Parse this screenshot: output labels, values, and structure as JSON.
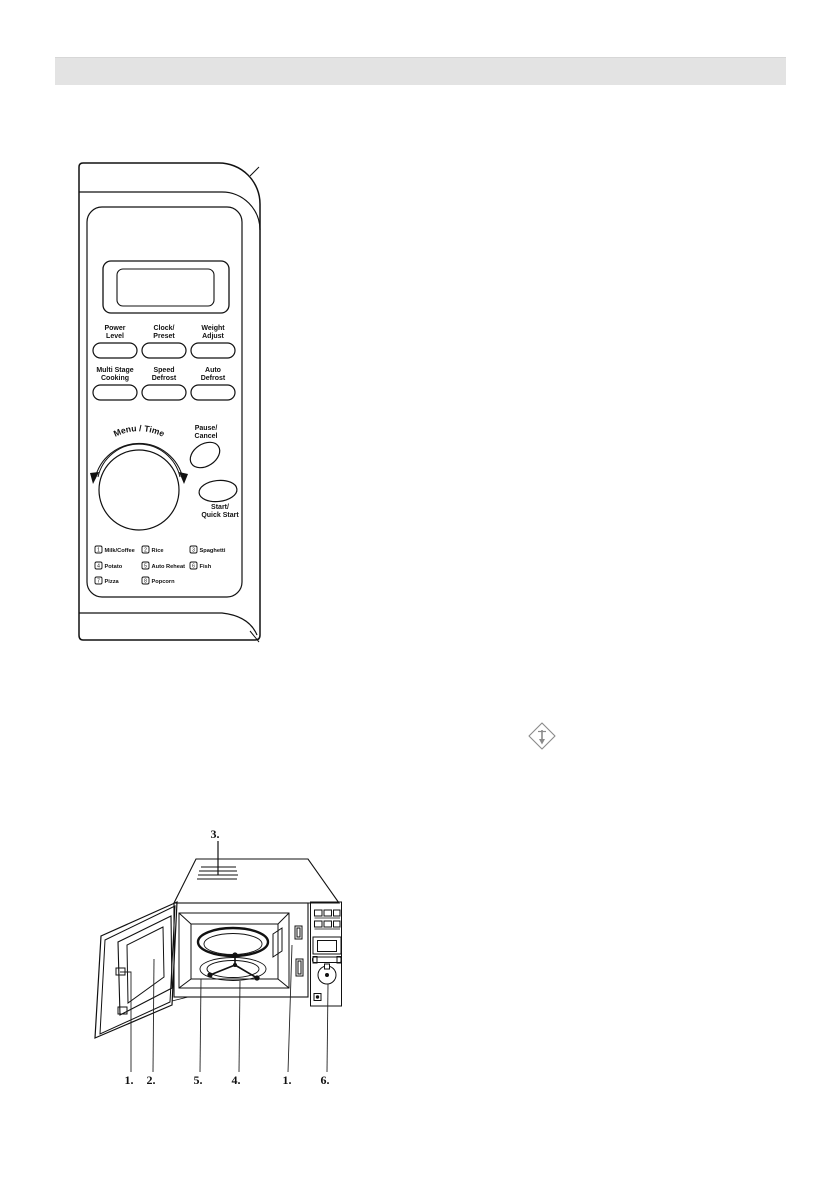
{
  "page": {
    "background_color": "#ffffff",
    "header_bar_color": "#e3e3e3",
    "line_color": "#111111",
    "diamond_icon_color": "#8a8a8a"
  },
  "icons": {
    "certification_mark": "diamond-certification-icon"
  },
  "control_panel": {
    "buttons": [
      {
        "line1": "Power",
        "line2": "Level"
      },
      {
        "line1": "Clock/",
        "line2": "Preset"
      },
      {
        "line1": "Weight",
        "line2": "Adjust"
      },
      {
        "line1": "Multi Stage",
        "line2": "Cooking"
      },
      {
        "line1": "Speed",
        "line2": "Defrost"
      },
      {
        "line1": "Auto",
        "line2": "Defrost"
      }
    ],
    "dial_label": "Menu / Time",
    "pause_button": {
      "line1": "Pause/",
      "line2": "Cancel"
    },
    "start_button": {
      "line1": "Start/",
      "line2": "Quick Start"
    },
    "presets": [
      {
        "num": "1",
        "label": "Milk/Coffee"
      },
      {
        "num": "2",
        "label": "Rice"
      },
      {
        "num": "3",
        "label": "Spaghetti"
      },
      {
        "num": "4",
        "label": "Potato"
      },
      {
        "num": "5",
        "label": "Auto Reheat"
      },
      {
        "num": "6",
        "label": "Fish"
      },
      {
        "num": "7",
        "label": "Pizza"
      },
      {
        "num": "8",
        "label": "Popcorn"
      }
    ]
  },
  "oven_diagram": {
    "top_callout": "3.",
    "bottom_callouts": [
      "1.",
      "2.",
      "5.",
      "4.",
      "1.",
      "6."
    ]
  }
}
